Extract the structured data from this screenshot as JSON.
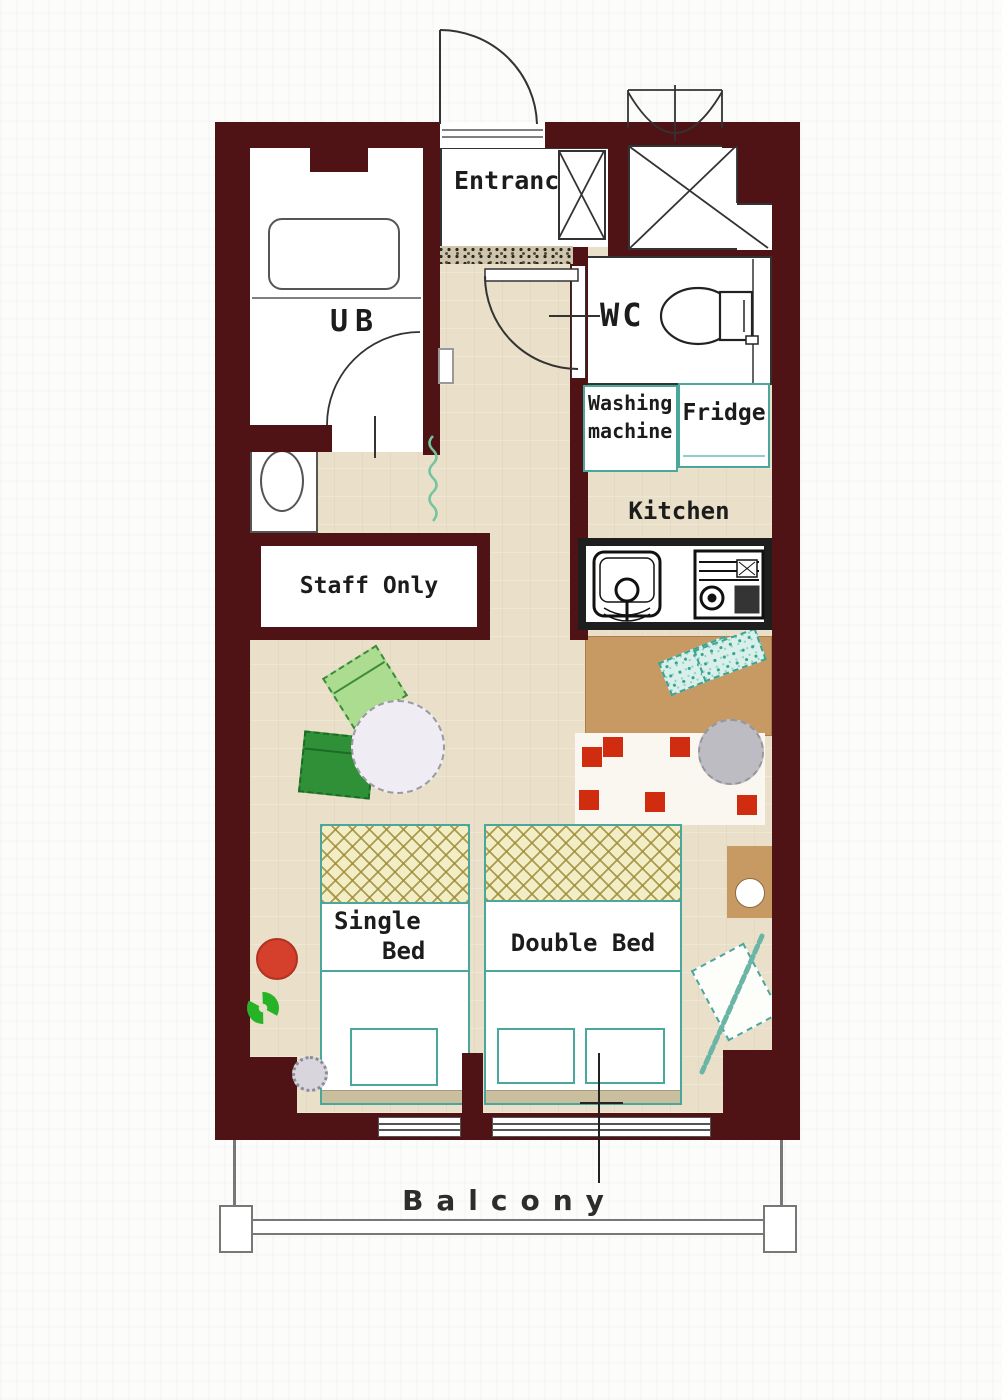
{
  "plan_title": "studio-room-floor-plan",
  "labels": {
    "entrance": "Entrance",
    "ub": "UB",
    "wc": "WC",
    "washing_line1": "Washing",
    "washing_line2": "machine",
    "fridge": "Fridge",
    "kitchen": "Kitchen",
    "staff_only": "Staff Only",
    "single_line1": "Single",
    "single_line2": "Bed",
    "double_bed": "Double Bed",
    "balcony": "Balcony"
  },
  "colors": {
    "wall": "#4f1316",
    "floor": "#eae0c9",
    "room_white": "#ffffff",
    "outline": "#2b2b2b",
    "teal": "#4aa79c",
    "pillow_yellow": "#f3edc6",
    "tan_foot": "#c9bf9e",
    "brown_counter": "#c79a63",
    "rug_white": "#faf7f0",
    "rug_red": "#cf2c10",
    "table_gray": "#efedf3",
    "chair_light": "#abdc8f",
    "chair_dark": "#2f9038",
    "wreath_green": "#27b327",
    "stool_red": "#d4402c",
    "pouf_gray": "#bcbcc2",
    "curtain_teal": "#74c4a0",
    "balcony_line": "#777777"
  }
}
